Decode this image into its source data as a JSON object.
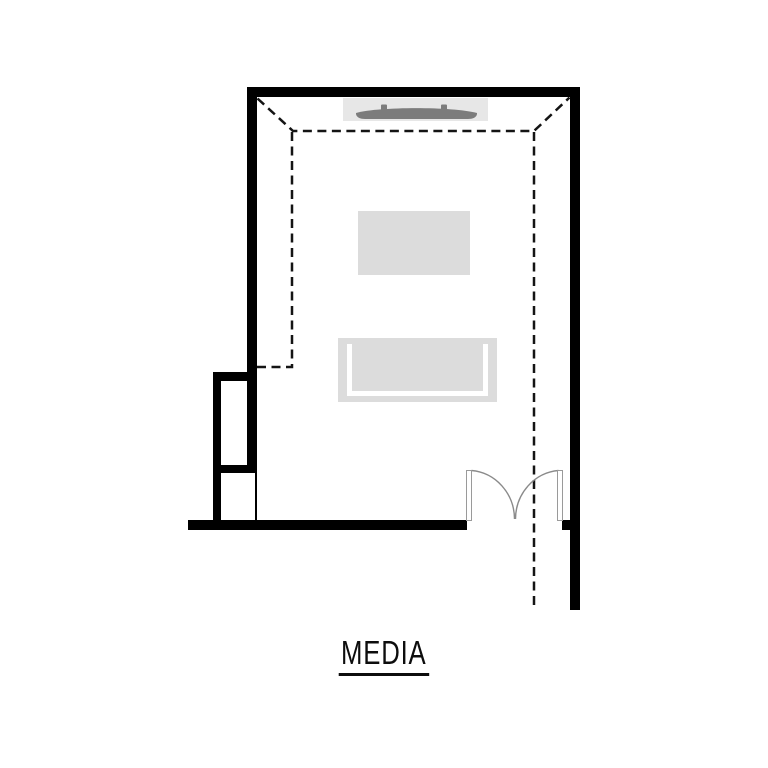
{
  "page": {
    "background": "#ffffff"
  },
  "floorplan": {
    "room_label": "MEDIA",
    "colors": {
      "wall": "#000000",
      "dashed_ceiling_line": "#141414",
      "sofa_fill": "#dcdcdc",
      "ottoman_fill": "#dcdcdc",
      "console_fill": "#e7e7e7",
      "tv_fill": "#7c7c7c",
      "door_swing_line": "#8a8a8a",
      "door_leaf_border": "#9a9a9a",
      "label_text": "#0d0d0d"
    },
    "features": {
      "ceiling": "tray-ceiling-dashed-outline",
      "tv": "wall-mounted-tv",
      "console": "media-console",
      "ottoman": "ottoman",
      "sofa": "sofa",
      "door": "double-swing-door",
      "nook": "left-wall-nook"
    }
  }
}
